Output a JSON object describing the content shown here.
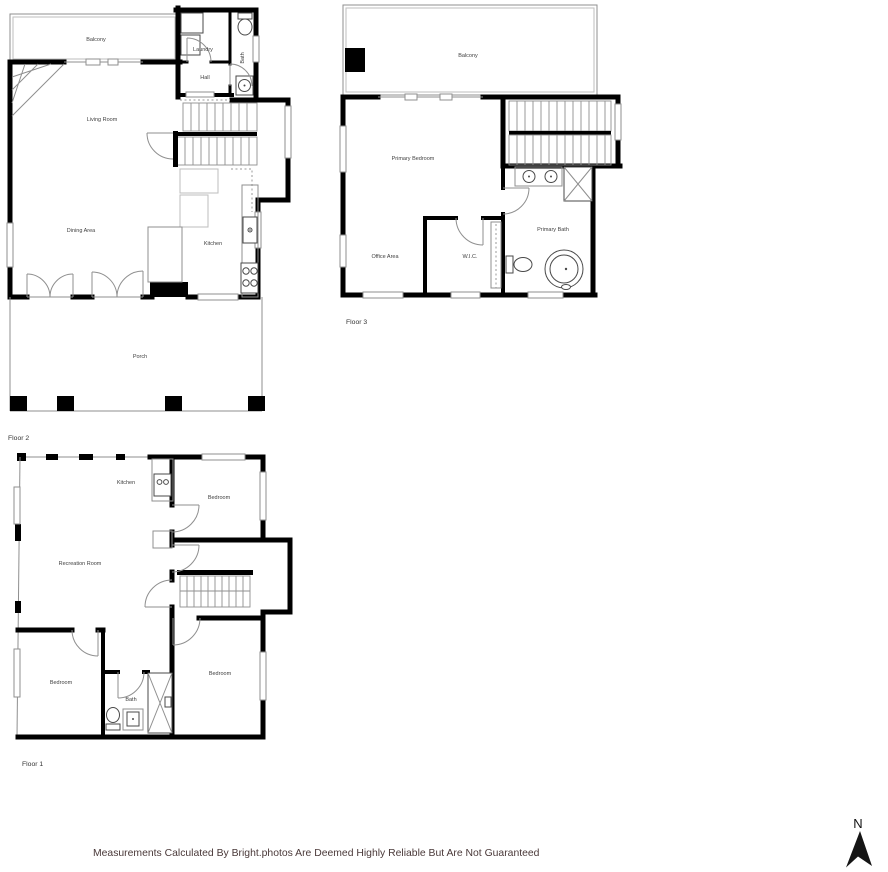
{
  "page": {
    "background": "#ffffff",
    "disclaimer": "Measurements Calculated By Bright.photos Are Deemed Highly Reliable But Are Not Guaranteed",
    "compass_label": "N"
  },
  "colors": {
    "wall": "#000000",
    "thin_line": "#8f8f8f",
    "room_label": "#3f3f3f",
    "floor_label": "#333333",
    "disclaimer_text": "#4a3939"
  },
  "floor2": {
    "label": "Floor 2",
    "rooms": {
      "balcony": "Balcony",
      "laundry": "Laundry",
      "bath": "Bath",
      "hall": "Hall",
      "living_room": "Living Room",
      "dining_area": "Dining Area",
      "kitchen": "Kitchen",
      "porch": "Porch"
    }
  },
  "floor3": {
    "label": "Floor 3",
    "rooms": {
      "balcony": "Balcony",
      "primary_bedroom": "Primary Bedroom",
      "office_area": "Office Area",
      "wic": "W.I.C.",
      "primary_bath": "Primary Bath"
    }
  },
  "floor1": {
    "label": "Floor 1",
    "rooms": {
      "kitchen": "Kitchen",
      "bedroom_top": "Bedroom",
      "recreation_room": "Recreation Room",
      "bedroom_left": "Bedroom",
      "bath": "Bath",
      "bedroom_right": "Bedroom"
    }
  }
}
